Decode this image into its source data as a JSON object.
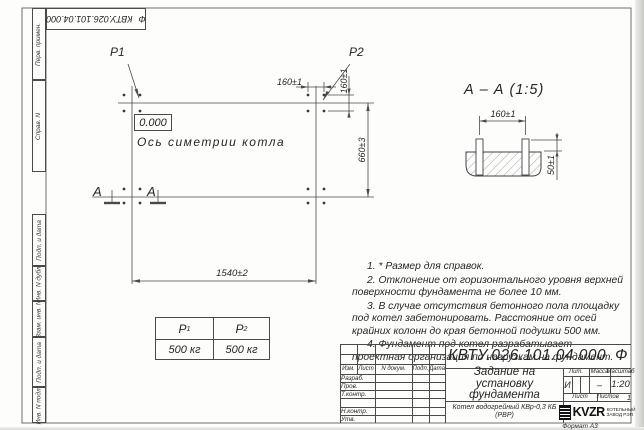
{
  "sheet": {
    "format_label": "Формат А3"
  },
  "margin_labels": [
    "Перв. примен.",
    "Справ. N",
    "Подп. и дата",
    "Инв. N дубл.",
    "Взам. инв. N",
    "Подп. и дата",
    "Инв. N подл."
  ],
  "plan": {
    "p1_label": "P1",
    "p2_label": "P2",
    "zero_mark": "0.000",
    "axis_label": "Ось симетрии котла",
    "section_letter": "А",
    "dim_bolt_x": "160±1",
    "dim_bolt_y": "160±1",
    "dim_length": "1540±2",
    "dim_width": "660±3"
  },
  "section_view": {
    "title": "А – А (1:5)",
    "dim_spacing": "160±1",
    "dim_height": "50±1"
  },
  "loads_table": {
    "col1": {
      "name": "P",
      "sub": "1",
      "value": "500 кг"
    },
    "col2": {
      "name": "P",
      "sub": "2",
      "value": "500 кг"
    }
  },
  "notes": [
    "1. * Размер для справок.",
    "2. Отклонение от горизонтального уровня верхней поверхности фундамента не более 10 мм.",
    "3. В случае отсутствия бетонного пола площадку под котел забетонировать. Расстояние от осей крайних колонн до края бетонной подушки 500 мм.",
    "4. Фундамент под котел разрабатывает проектная организация по нагрузкам на фундамент."
  ],
  "titleblock": {
    "doc_number": "КВТУ.026.101.04.000",
    "doc_suffix": "Ф",
    "title": "Задание на установку фундамента",
    "product": "Котел водогрейный КВр-0,3 КБ (РВР)",
    "header_cols": [
      "Изм.",
      "Лист",
      "N докум.",
      "Подп.",
      "Дата"
    ],
    "row_labels": [
      "Разраб.",
      "Пров.",
      "Т.контр.",
      "",
      "Н.контр.",
      "Утв."
    ],
    "lit_label": "Лит.",
    "lit_value": "И",
    "mass_label": "Масса",
    "mass_value": "–",
    "scale_label": "Масштаб",
    "scale_value": "1:20",
    "sheet_label": "Лист",
    "sheets_label": "Листов",
    "sheets_value": "1",
    "brand": "KVZR",
    "brand_sub1": "КОТЕЛЬНЫЙ",
    "brand_sub2": "ЗАВОД РЭП",
    "colors": {
      "line": "#4a4a4a",
      "ink": "#262626"
    }
  }
}
